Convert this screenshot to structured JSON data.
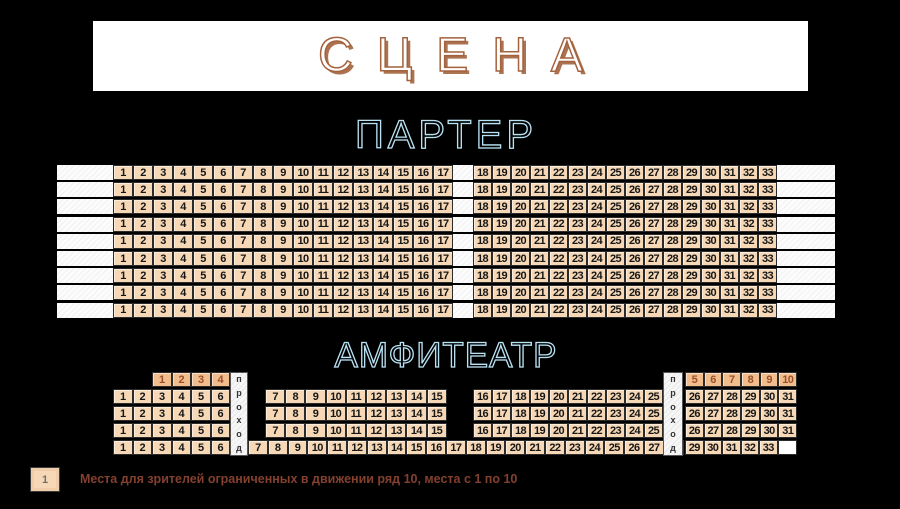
{
  "stage": {
    "label": "СЦЕНА"
  },
  "parterre": {
    "title": "ПАРТЕР",
    "row_count": 9,
    "blocks": [
      {
        "from": 1,
        "to": 17
      },
      {
        "from": 18,
        "to": 33
      }
    ]
  },
  "amphitheatre": {
    "title": "АМФИТЕАТР",
    "aisle_label": "проход",
    "accessible_row_number": 10,
    "accessible_blocks": [
      {
        "from": 1,
        "to": 4
      },
      {
        "from": 5,
        "to": 10
      }
    ],
    "rows": [
      {
        "blocks": [
          {
            "from": 1,
            "to": 6
          },
          {
            "from": 7,
            "to": 15
          },
          {
            "from": 16,
            "to": 25
          },
          {
            "from": 26,
            "to": 31
          }
        ]
      },
      {
        "blocks": [
          {
            "from": 1,
            "to": 6
          },
          {
            "from": 7,
            "to": 15
          },
          {
            "from": 16,
            "to": 25
          },
          {
            "from": 26,
            "to": 31
          }
        ]
      },
      {
        "blocks": [
          {
            "from": 1,
            "to": 6
          },
          {
            "from": 7,
            "to": 15
          },
          {
            "from": 16,
            "to": 25
          },
          {
            "from": 26,
            "to": 31
          }
        ]
      }
    ],
    "last_row": {
      "blocks": [
        {
          "from": 1,
          "to": 6
        },
        {
          "from": 7,
          "to": 28
        },
        {
          "from": 29,
          "to": 33
        }
      ],
      "has_trailing_empty_seat": true
    }
  },
  "legend": {
    "symbol": "1",
    "text": "Места для зрителей ограниченных в движении ряд 10, места с 1 по 10"
  },
  "colors": {
    "background": "#000000",
    "banner": "#ffffff",
    "seat_fill": "#f6d8b6",
    "seat_border": "#2b2b2b",
    "accessible_fill": "#f1bd8d",
    "accessible_number": "#9c4f28",
    "heading_blue": "#b9e3f4",
    "stage_outline": "#a4633e",
    "stage_shadow": "#ab7350",
    "legend_text": "#84402f"
  }
}
